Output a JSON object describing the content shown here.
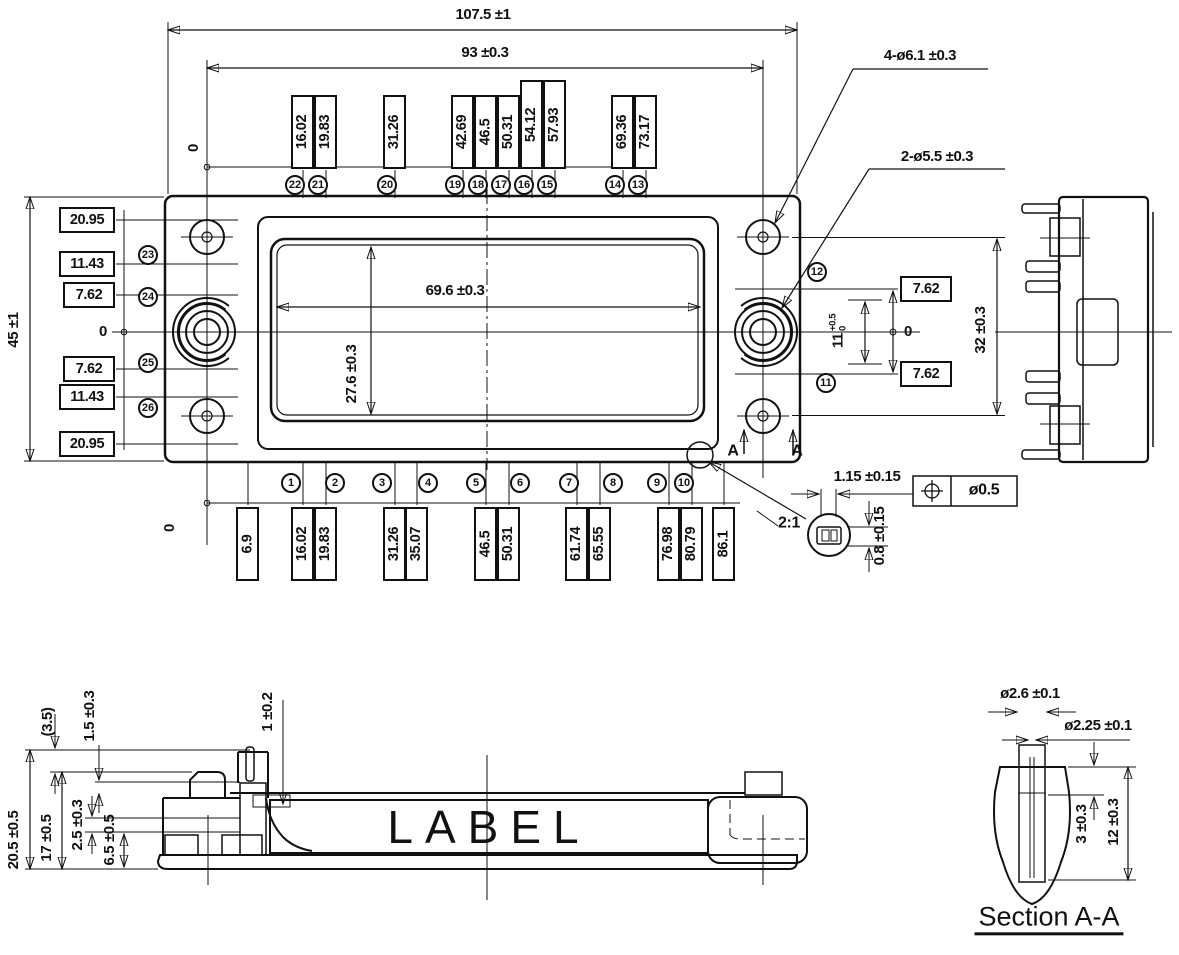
{
  "top_view": {
    "dim_overall": "107.5 ±1",
    "dim_span": "93 ±0.3",
    "dim_height": "45 ±1",
    "origin_top": "0",
    "origin_left": "0",
    "origin_bottom": "0",
    "origin_right": "0",
    "window_dim_w": "69.6 ±0.3",
    "window_dim_h": "27.6 ±0.3",
    "callout_corner_holes": "4-ø6.1 ±0.3",
    "callout_center_holes": "2-ø5.5 ±0.3",
    "top_pin_offsets": [
      "16.02",
      "19.83",
      "31.26",
      "42.69",
      "46.5",
      "50.31",
      "54.12",
      "57.93",
      "69.36",
      "73.17"
    ],
    "top_pin_numbers": [
      "22",
      "21",
      "20",
      "19",
      "18",
      "17",
      "16",
      "15",
      "14",
      "13"
    ],
    "bottom_pin_offsets": [
      "6.9",
      "16.02",
      "19.83",
      "31.26",
      "35.07",
      "46.5",
      "50.31",
      "61.74",
      "65.55",
      "76.98",
      "80.79",
      "86.1"
    ],
    "bottom_pin_numbers": [
      "1",
      "2",
      "3",
      "4",
      "5",
      "6",
      "7",
      "8",
      "9",
      "10"
    ],
    "left_offsets": [
      "20.95",
      "11.43",
      "7.62",
      "7.62",
      "11.43",
      "20.95"
    ],
    "left_pin_numbers": [
      "23",
      "24",
      "25",
      "26"
    ],
    "right_offsets": [
      "7.62",
      "7.62"
    ],
    "right_pin_numbers": [
      "12",
      "11"
    ],
    "right_span_value": "11",
    "right_span_tol_up": "+0.5",
    "right_span_tol_dn": "0",
    "dim_hole_span": "32 ±0.3",
    "section_marker": "A"
  },
  "detail_view": {
    "scale": "2:1",
    "dim_w": "1.15 ±0.15",
    "dim_h": "0.8 ±0.15",
    "fcf_value": "ø0.5"
  },
  "front_view": {
    "label_text": "LABEL",
    "dim_pin_height": "(3.5)",
    "dim_lid_step": "1.5 ±0.3",
    "dim_pin_seat": "1 ±0.2",
    "dim_overall_h": "20.5 ±0.5",
    "dim_body_h": "17 ±0.5",
    "dim_step": "2.5 ±0.3",
    "dim_base": "6.5 ±0.5"
  },
  "section_view": {
    "title": "Section A-A",
    "dim_bore_outer": "ø2.6 ±0.1",
    "dim_bore_inner": "ø2.25 ±0.1",
    "dim_depth_step": "3 ±0.3",
    "dim_depth_full": "12 ±0.3"
  }
}
